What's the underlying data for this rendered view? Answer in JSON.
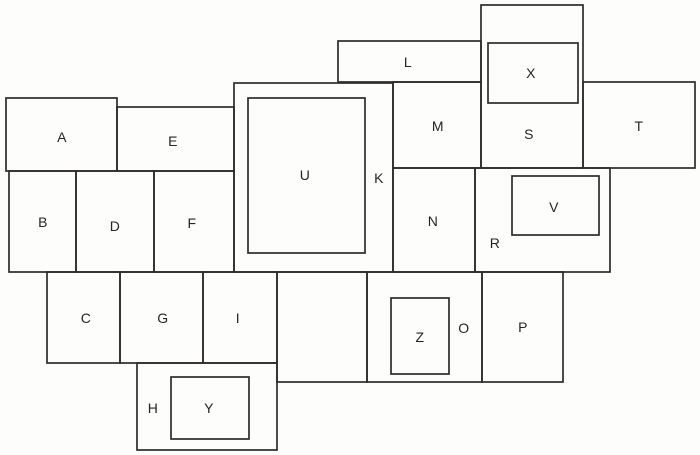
{
  "figure": {
    "description": "rectangle-puzzle-diagram",
    "canvas": {
      "width": 700,
      "height": 455
    },
    "background": "#fdfdfc",
    "line_color": "#2e2c2a",
    "label_color": "#272523",
    "stroke_width": 1.7,
    "font_size": 14,
    "regions": [
      {
        "label": "A",
        "box": [
          6,
          98,
          117,
          171
        ],
        "label_at": [
          62,
          137
        ]
      },
      {
        "label": "E",
        "box": [
          117,
          107,
          234,
          171
        ],
        "label_at": [
          173,
          141
        ]
      },
      {
        "label": "B",
        "box": [
          9,
          171,
          76,
          272
        ],
        "label_at": [
          43,
          222
        ]
      },
      {
        "label": "D",
        "box": [
          76,
          171,
          154,
          272
        ],
        "label_at": [
          115,
          226
        ]
      },
      {
        "label": "F",
        "box": [
          154,
          171,
          234,
          272
        ],
        "label_at": [
          192,
          223
        ]
      },
      {
        "label": "C",
        "box": [
          47,
          272,
          120,
          363
        ],
        "label_at": [
          86,
          318
        ]
      },
      {
        "label": "G",
        "box": [
          120,
          272,
          203,
          363
        ],
        "label_at": [
          163,
          318
        ]
      },
      {
        "label": "I",
        "box": [
          203,
          272,
          277,
          363
        ],
        "label_at": [
          238,
          318
        ]
      },
      {
        "label": "H",
        "box": [
          137,
          363,
          277,
          450
        ],
        "label_at": [
          153,
          408
        ]
      },
      {
        "label": "Y",
        "box": [
          171,
          377,
          249,
          439
        ],
        "label_at": [
          209,
          408
        ]
      },
      {
        "label": "K",
        "box": [
          234,
          83,
          393,
          272
        ],
        "label_at": [
          379,
          178
        ]
      },
      {
        "label": "U",
        "box": [
          248,
          98,
          365,
          253
        ],
        "label_at": [
          305,
          175
        ]
      },
      {
        "label": "L",
        "box": [
          338,
          41,
          481,
          82
        ],
        "label_at": [
          408,
          62
        ]
      },
      {
        "label": "S",
        "box": [
          481,
          5,
          583,
          168
        ],
        "label_at": [
          529,
          134
        ]
      },
      {
        "label": "X",
        "box": [
          488,
          43,
          578,
          103
        ],
        "label_at": [
          531,
          73
        ]
      },
      {
        "label": "M",
        "box": [
          393,
          82,
          481,
          168
        ],
        "label_at": [
          438,
          126
        ]
      },
      {
        "label": "T",
        "box": [
          583,
          82,
          695,
          168
        ],
        "label_at": [
          639,
          126
        ]
      },
      {
        "label": "N",
        "box": [
          393,
          168,
          475,
          272
        ],
        "label_at": [
          433,
          221
        ]
      },
      {
        "label": "R",
        "box": [
          475,
          168,
          610,
          272
        ],
        "label_at": [
          495,
          243
        ]
      },
      {
        "label": "V",
        "box": [
          512,
          176,
          599,
          235
        ],
        "label_at": [
          554,
          207
        ]
      },
      {
        "label": "",
        "box": [
          277,
          272,
          367,
          382
        ],
        "label_at": null
      },
      {
        "label": "O",
        "box": [
          367,
          272,
          482,
          382
        ],
        "label_at": [
          464,
          328
        ]
      },
      {
        "label": "Z",
        "box": [
          391,
          298,
          449,
          374
        ],
        "label_at": [
          420,
          337
        ]
      },
      {
        "label": "P",
        "box": [
          482,
          272,
          563,
          382
        ],
        "label_at": [
          523,
          327
        ]
      }
    ]
  }
}
